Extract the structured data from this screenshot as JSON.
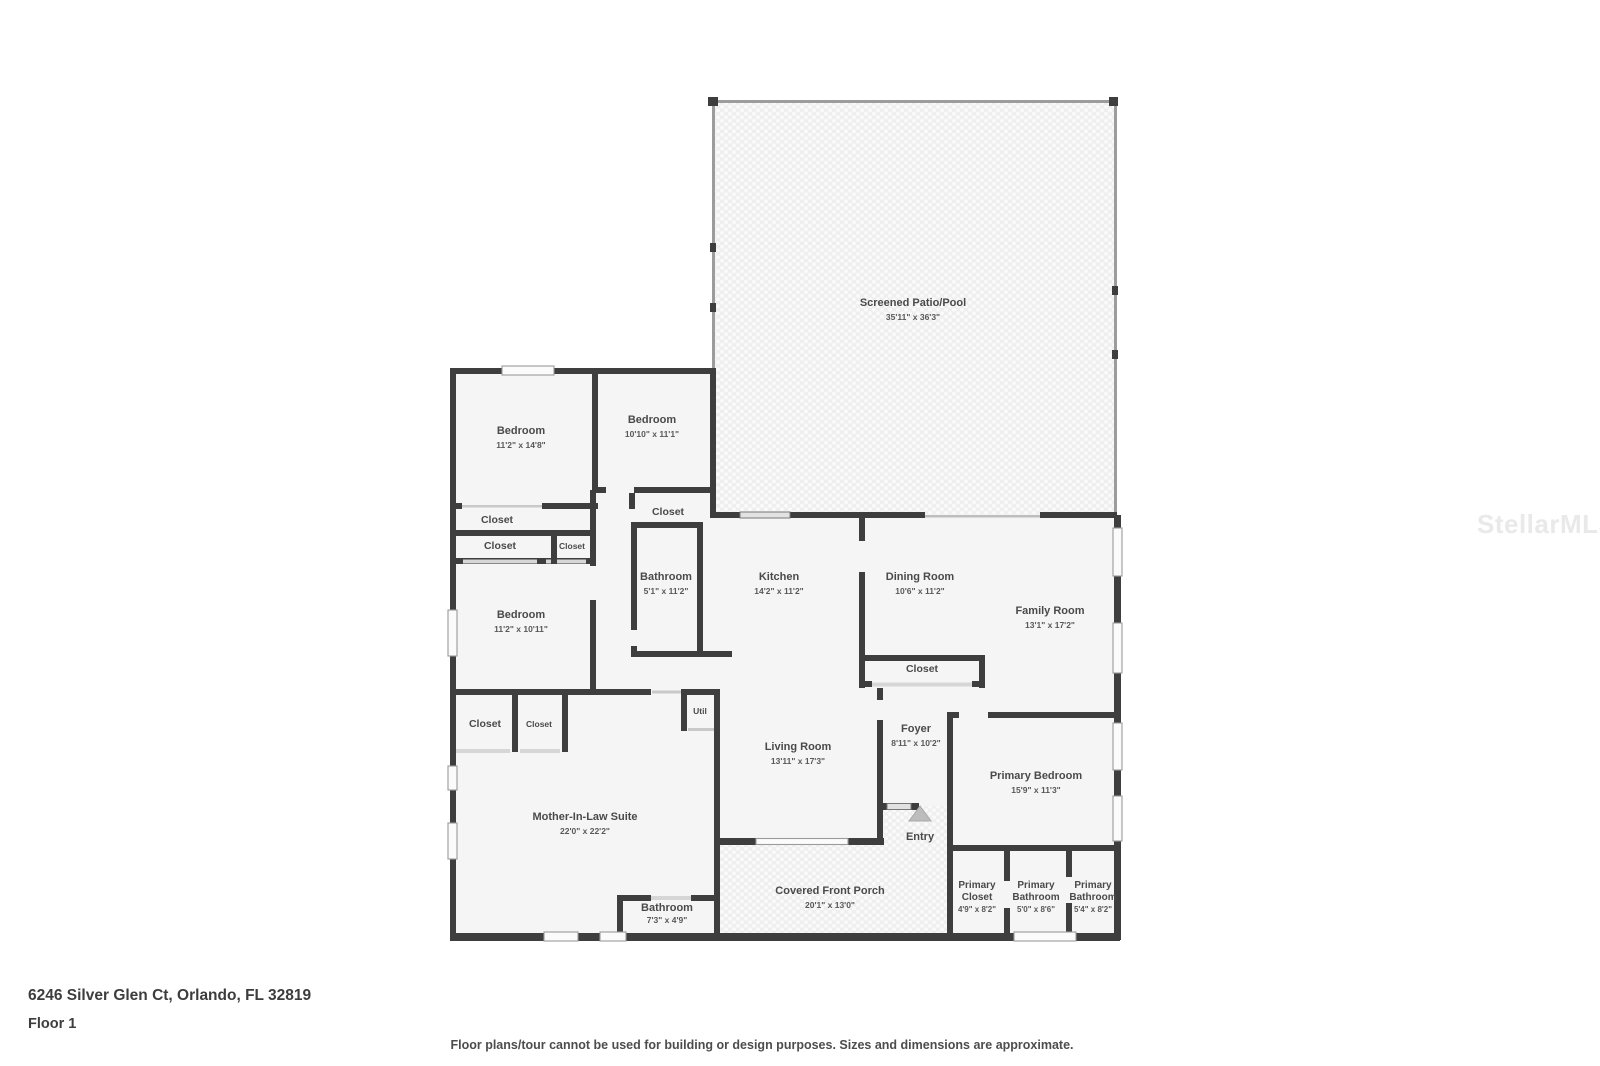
{
  "page": {
    "address": "6246 Silver Glen Ct, Orlando, FL 32819",
    "floor_label": "Floor 1",
    "disclaimer": "Floor plans/tour cannot be used for building or design purposes. Sizes and dimensions are approximate.",
    "watermark": "StellarMLS"
  },
  "rooms": {
    "screened_patio_pool": {
      "name": "Screened Patio/Pool",
      "dims": "35'11\" x 36'3\""
    },
    "bedroom_1": {
      "name": "Bedroom",
      "dims": "11'2\" x 14'8\""
    },
    "bedroom_2": {
      "name": "Bedroom",
      "dims": "10'10\" x 11'1\""
    },
    "bedroom_3": {
      "name": "Bedroom",
      "dims": "11'2\" x 10'11\""
    },
    "hall_bathroom": {
      "name": "Bathroom",
      "dims": "5'1\" x 11'2\""
    },
    "kitchen": {
      "name": "Kitchen",
      "dims": "14'2\" x 11'2\""
    },
    "dining_room": {
      "name": "Dining Room",
      "dims": "10'6\" x 11'2\""
    },
    "family_room": {
      "name": "Family Room",
      "dims": "13'1\" x 17'2\""
    },
    "living_room": {
      "name": "Living Room",
      "dims": "13'11\" x 17'3\""
    },
    "foyer": {
      "name": "Foyer",
      "dims": "8'11\" x 10'2\""
    },
    "entry": {
      "name": "Entry"
    },
    "util": {
      "name": "Util"
    },
    "primary_bedroom": {
      "name": "Primary Bedroom",
      "dims": "15'9\" x 11'3\""
    },
    "primary_closet": {
      "line1": "Primary",
      "line2": "Closet",
      "dims": "4'9\" x 8'2\""
    },
    "primary_bathroom_1": {
      "line1": "Primary",
      "line2": "Bathroom",
      "dims": "5'0\" x 8'6\""
    },
    "primary_bathroom_2": {
      "line1": "Primary",
      "line2": "Bathroom",
      "dims": "5'4\" x 8'2\""
    },
    "mother_in_law_suite": {
      "name": "Mother-In-Law Suite",
      "dims": "22'0\" x 22'2\""
    },
    "mil_bathroom": {
      "name": "Bathroom",
      "dims": "7'3\" x 4'9\""
    },
    "covered_front_porch": {
      "name": "Covered Front Porch",
      "dims": "20'1\" x 13'0\""
    }
  },
  "closets": {
    "closet_label": "Closet"
  }
}
